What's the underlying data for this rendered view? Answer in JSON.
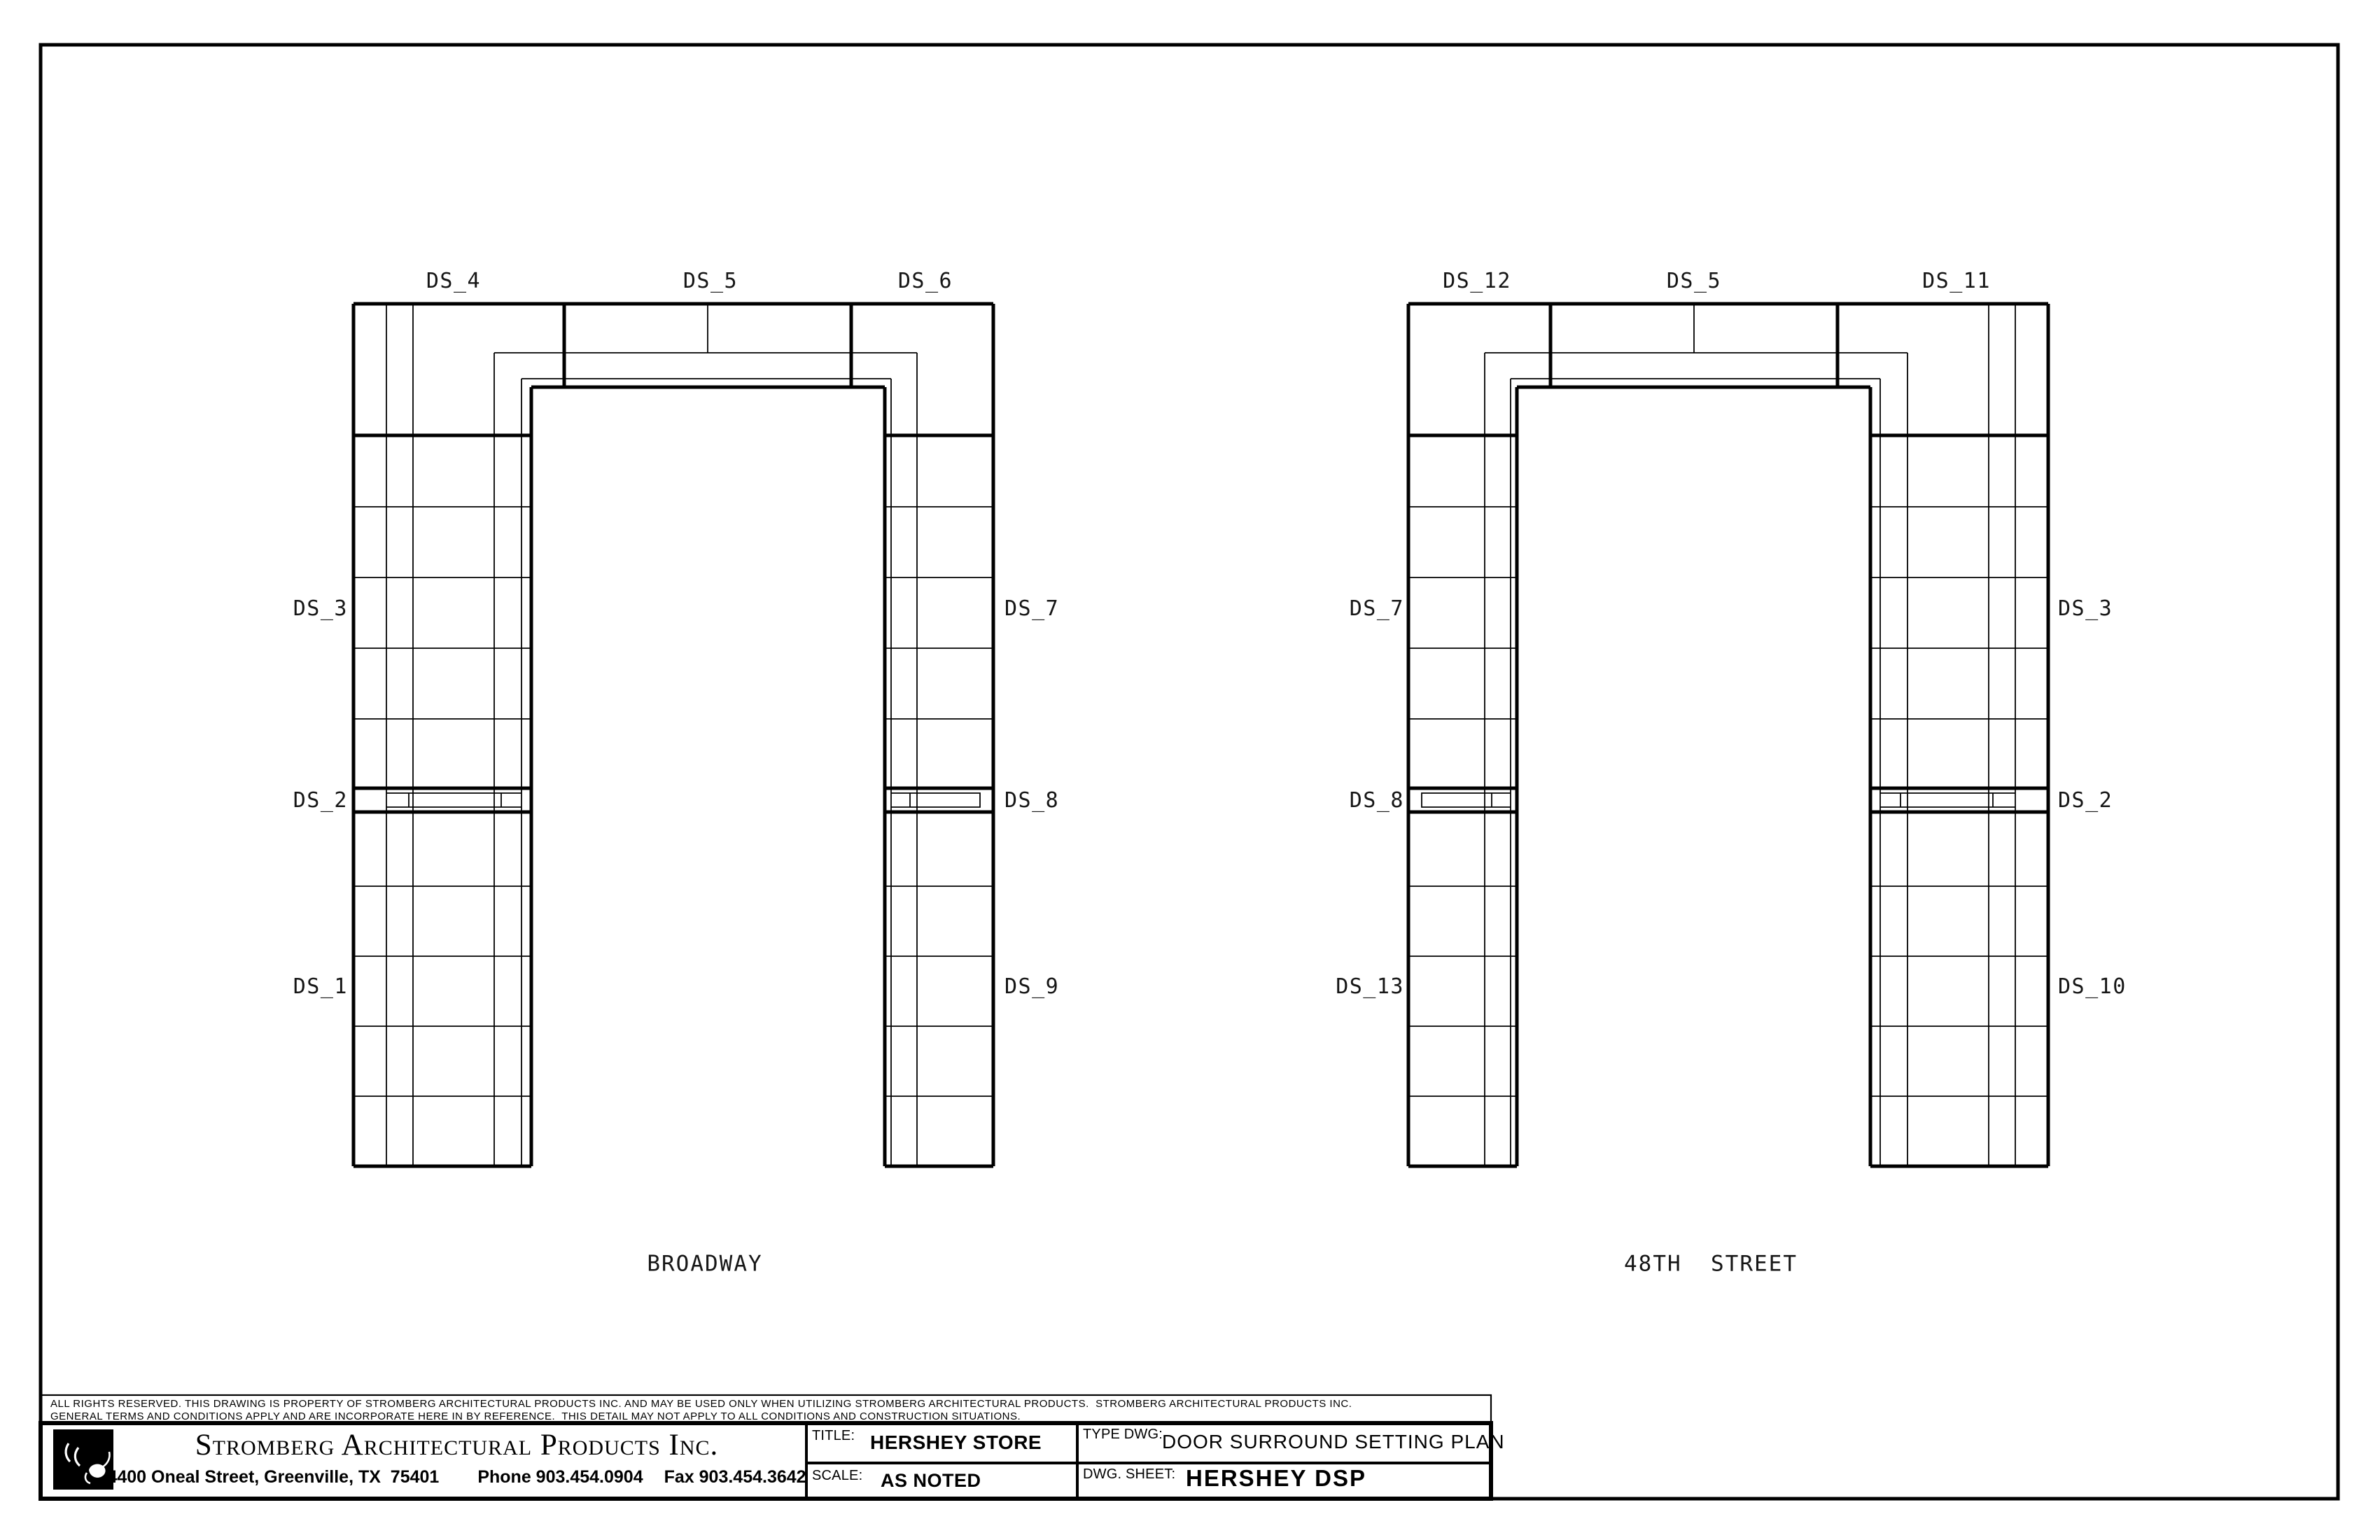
{
  "sheet_type": "architectural drawing - door surround setting plan",
  "drawings": [
    {
      "caption": "BROADWAY",
      "header_labels": [
        "DS_4",
        "DS_5",
        "DS_6"
      ],
      "left_labels": [
        "DS_3",
        "DS_2",
        "DS_1"
      ],
      "right_labels": [
        "DS_7",
        "DS_8",
        "DS_9"
      ]
    },
    {
      "caption": "48TH  STREET",
      "header_labels": [
        "DS_12",
        "DS_5",
        "DS_11"
      ],
      "left_labels": [
        "DS_7",
        "DS_8",
        "DS_13"
      ],
      "right_labels": [
        "DS_3",
        "DS_2",
        "DS_10"
      ]
    }
  ],
  "title_block": {
    "disclaimer_line1": "ALL RIGHTS RESERVED. THIS DRAWING IS PROPERTY OF STROMBERG ARCHITECTURAL PRODUCTS INC. AND MAY BE USED ONLY WHEN UTILIZING STROMBERG ARCHITECTURAL PRODUCTS.  STROMBERG ARCHITECTURAL PRODUCTS INC.",
    "disclaimer_line2": "GENERAL TERMS AND CONDITIONS APPLY AND ARE INCORPORATE HERE IN BY REFERENCE.  THIS DETAIL MAY NOT APPLY TO ALL CONDITIONS AND CONSTRUCTION SITUATIONS.",
    "company_name": "Stromberg Architectural Products Inc.",
    "address": "4400 Oneal Street, Greenville, TX  75401",
    "phone": "Phone 903.454.0904",
    "fax": "Fax 903.454.3642",
    "title_label": "TITLE:",
    "title_value": "HERSHEY STORE",
    "scale_label": "SCALE:",
    "scale_value": "AS NOTED",
    "type_dwg_label": "TYPE DWG:",
    "type_dwg_value": "DOOR SURROUND SETTING PLAN",
    "sheet_label": "DWG. SHEET:",
    "sheet_value": "HERSHEY DSP"
  },
  "colors": {
    "ink": "#000000",
    "paper": "#ffffff"
  }
}
